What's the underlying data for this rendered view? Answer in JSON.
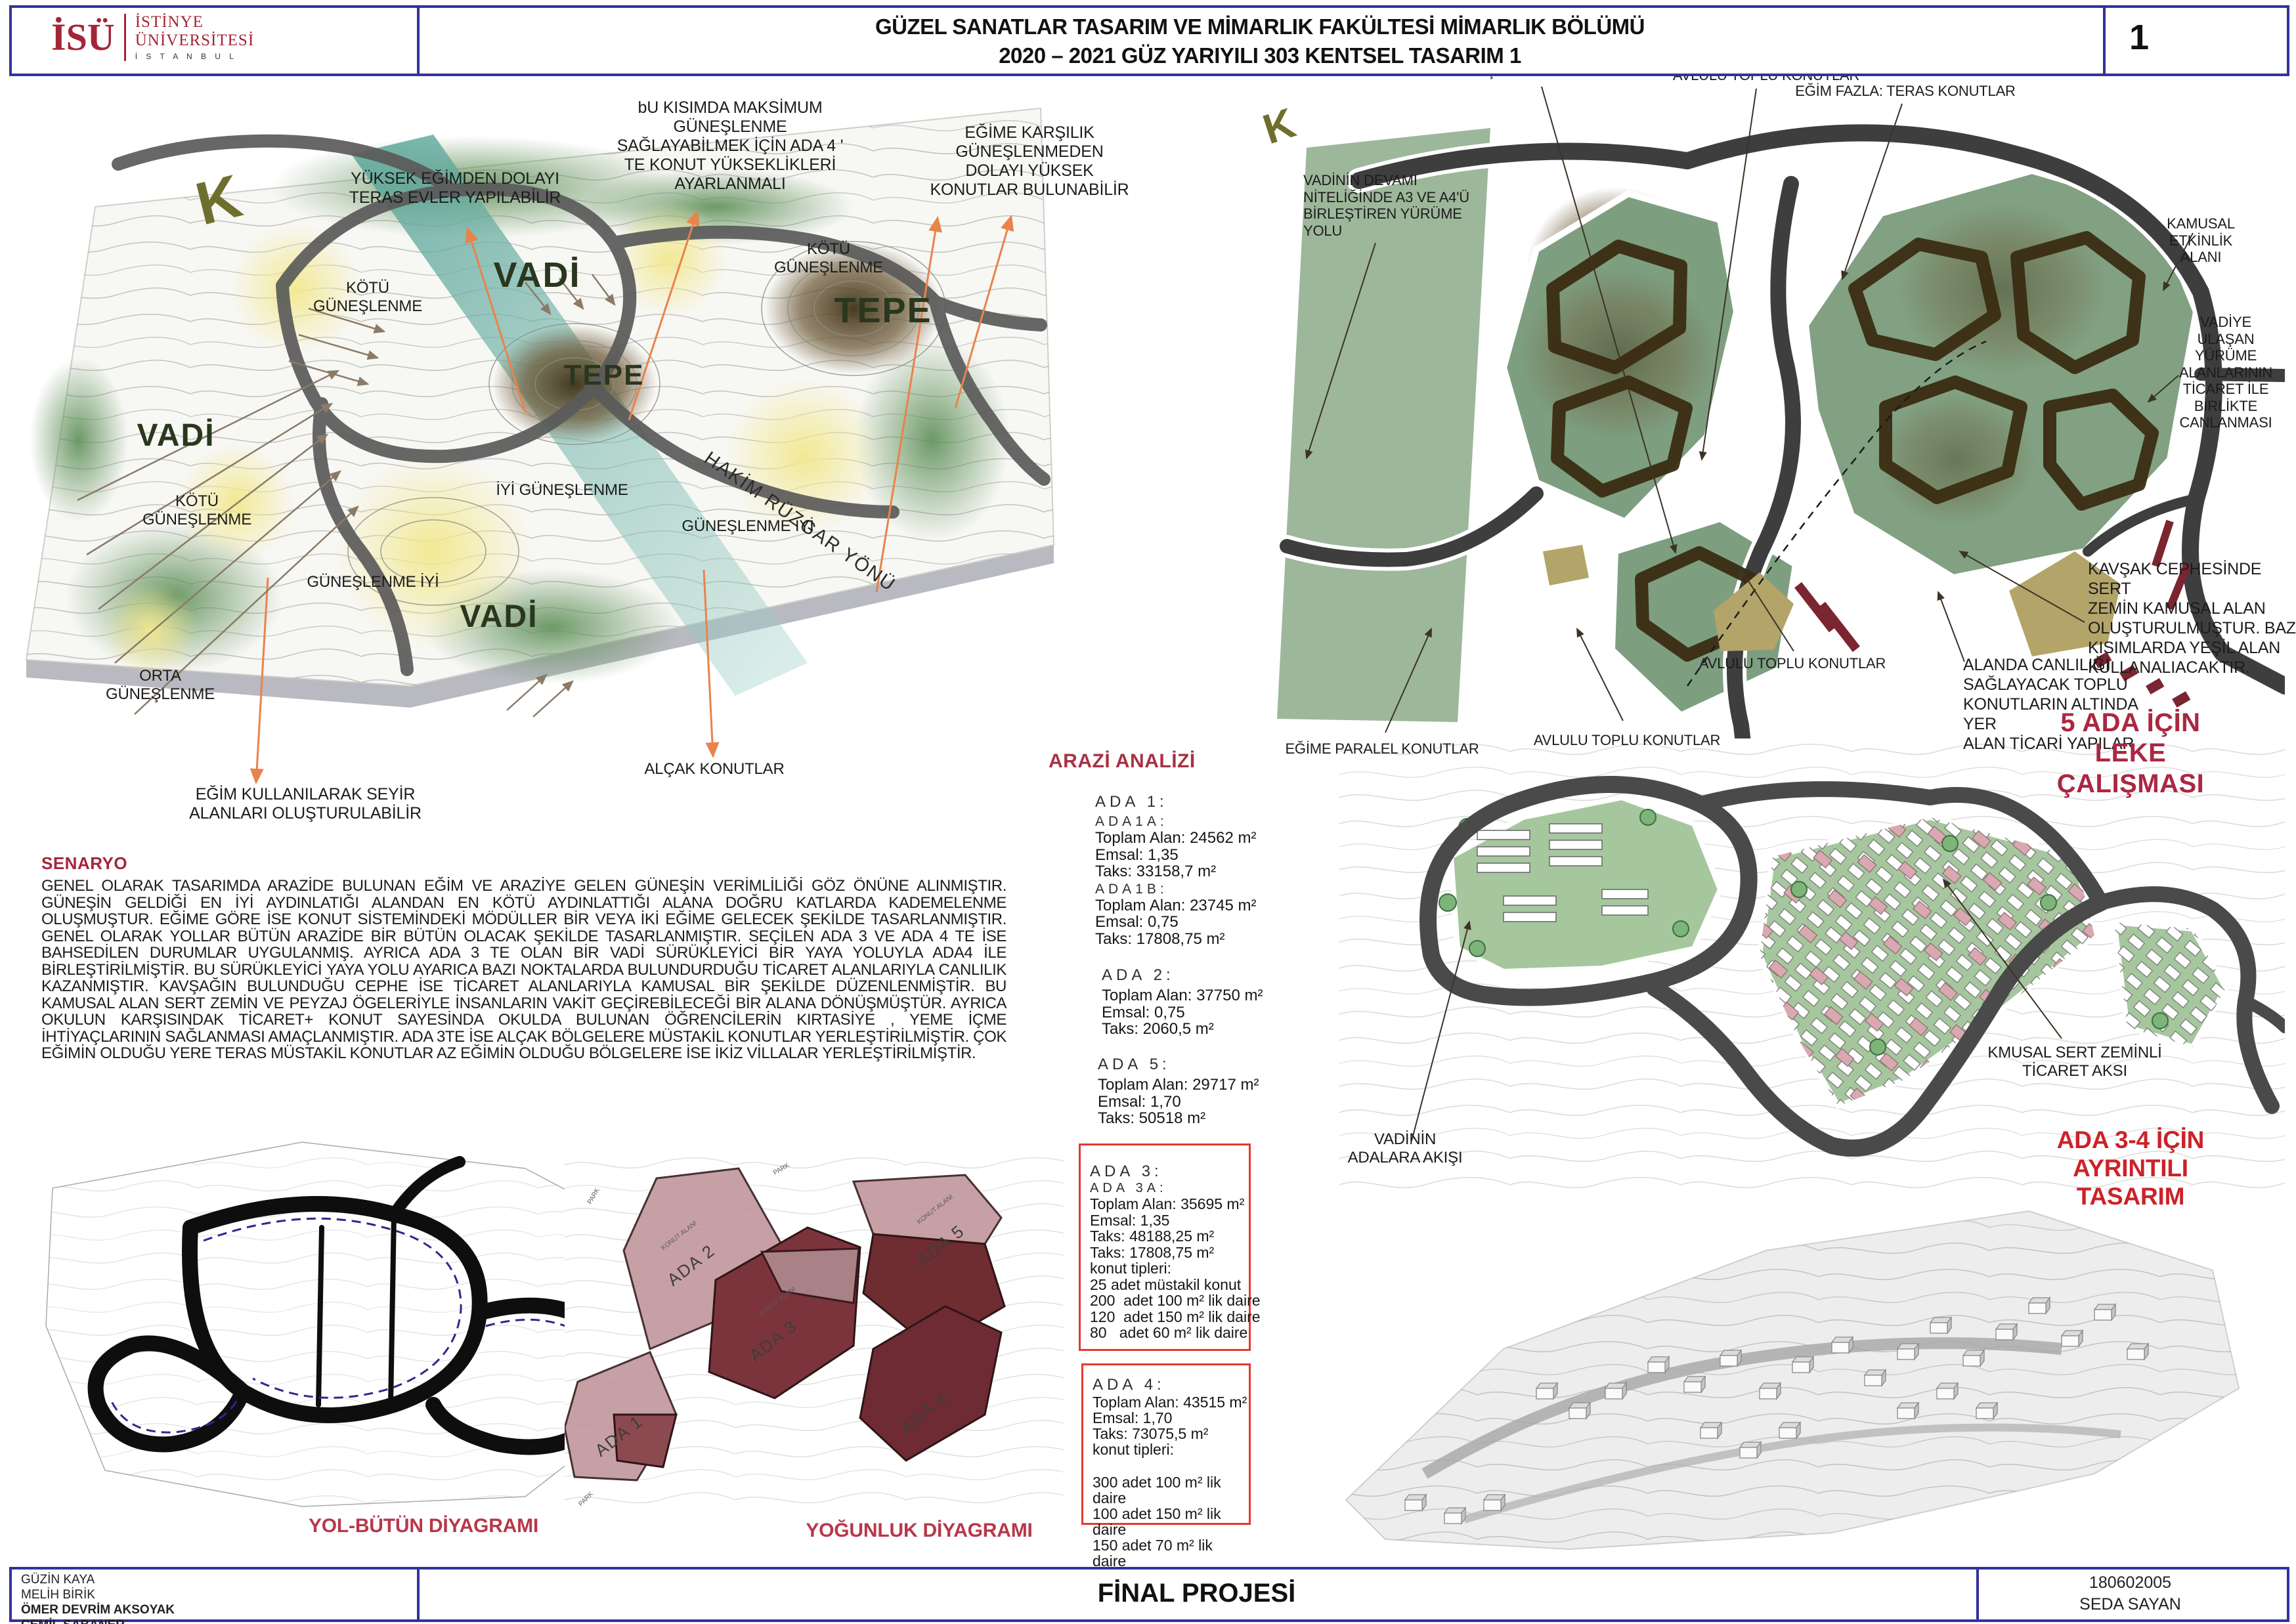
{
  "header": {
    "logo_acronym": "İSÜ",
    "logo_line1": "İSTİNYE",
    "logo_line2": "ÜNİVERSİTESİ",
    "logo_line3": "İ S T A N B U L",
    "title_line1": "GÜZEL SANATLAR TASARIM VE MİMARLIK FAKÜLTESİ MİMARLIK BÖLÜMÜ",
    "title_line2": "2020 – 2021 GÜZ YARIYILI 303 KENTSEL TASARIM 1",
    "page_number": "1"
  },
  "left_map": {
    "compass": "K",
    "vadi_top": "VADİ",
    "vadi_left": "VADİ",
    "vadi_bottom": "VADİ",
    "tepe_right": "TEPE",
    "tepe_center": "TEPE",
    "kotu_guneslenme_topleft": "KÖTÜ\nGÜNEŞLENME",
    "kotu_guneslenme_topright": "KÖTÜ\nGÜNEŞLENME",
    "kotu_guneslenme_left": "KÖTÜ\nGÜNEŞLENME",
    "iyi_guneslenme": "İYİ GÜNEŞLENME",
    "guneslenme_iyi_mid": "GÜNEŞLENME İYİ",
    "guneslenme_iyi_left": "GÜNEŞLENME İYİ",
    "orta_guneslenme": "ORTA\nGÜNEŞLENME",
    "hakim_ruzgar": "HAKİM RÜZGAR YÖNÜ",
    "ann_teras": "YÜKSEK EĞİMDEN DOLAYI\nTERAS EVLER YAPILABİLİR",
    "ann_maksimum": "bU KISIMDA MAKSİMUM\nGÜNEŞLENME\nSAĞLAYABİLMEK İÇİN ADA 4 '\nTE KONUT YÜKSEKLİKLERİ\nAYARLANMALI",
    "ann_egime_karsilik": "EĞİME KARŞILIK\nGÜNEŞLENMEDEN\nDOLAYI  YÜKSEK\nKONUTLAR BULUNABİLİR",
    "ann_seyir": "EĞİM KULLANILARAK SEYİR\nALANLARI OLUŞTURULABİLİR",
    "ann_alcak": "ALÇAK KONUTLAR"
  },
  "right_map": {
    "compass": "K",
    "ann_okul": "OKUL KARŞISINDAKİ KIRTASİYE ALANI",
    "ann_avlulu_top": "AVLULU TOPLU KONUTLAR",
    "ann_egim_fazla": "EĞİM FAZLA: TERAS KONUTLAR",
    "ann_kamusal": "KAMUSAL ETKİNLİK ALANI",
    "ann_vadinin_devami": "VADİNİN DEVAMI\nNİTELİĞİNDE A3 VE A4'Ü\nBİRLEŞTİREN YÜRÜME YOLU",
    "ann_vadiye": "VADİYE ULAŞAN YÜRÜME\nALANLARININ TİCARET İLE\nBİRLİKTE CANLANMASI",
    "ann_kavsak": "KAVŞAK CEPHESİNDE SERT\nZEMİN KAMUSAL ALAN\nOLUŞTURULMUŞTUR. BAZI\nKISIMLARDA YEŞİL ALAN\nKULLANALIACAKTIR.",
    "ann_alanda": "ALANDA CANLILIĞI\nSAĞLAYACAK TOPLU\nKONUTLARIN ALTINDA YER\nALAN TİCARİ YAPILAR",
    "ann_avlulu_right": "AVLULU TOPLU KONUTLAR",
    "ann_avlulu_bottom": "AVLULU TOPLU KONUTLAR",
    "ann_egime_paralel": "EĞİME PARALEL KONUTLAR",
    "leke_title": "5 ADA İÇİN LEKE ÇALIŞMASI"
  },
  "senaryo": {
    "heading": "SENARYO",
    "body": "GENEL OLARAK TASARIMDA ARAZİDE BULUNAN EĞİM VE ARAZİYE GELEN GÜNEŞİN VERİMLİLİĞİ GÖZ ÖNÜNE ALINMIŞTIR. GÜNEŞİN GELDİĞİ EN İYİ AYDINLATIĞI ALANDAN EN KÖTÜ AYDINLATTIĞI ALANA DOĞRU KATLARDA  KADEMELENME OLUŞMUŞTUR. EĞİME GÖRE İSE KONUT SİSTEMİNDEKİ MÖDÜLLER BİR VEYA İKİ EĞİME GELECEK ŞEKİLDE TASARLANMIŞTIR. GENEL OLARAK YOLLAR BÜTÜN ARAZİDE BİR BÜTÜN OLACAK ŞEKİLDE TASARLANMIŞTIR. SEÇİLEN ADA 3 VE ADA 4 TE İSE BAHSEDİLEN DURUMLAR UYGULANMIŞ. AYRICA ADA 3 TE OLAN BİR VADİ SÜRÜKLEYİCİ BİR YAYA YOLUYLA ADA4 İLE BİRLEŞTİRİLMİŞTİR. BU SÜRÜKLEYİCİ YAYA YOLU AYARICA BAZI NOKTALARDA BULUNDURDUĞU TİCARET ALANLARIYLA CANLILIK KAZANMIŞTIR. KAVŞAĞIN BULUNDUĞU CEPHE İSE TİCARET ALANLARIYLA KAMUSAL BİR ŞEKİLDE DÜZENLENMİŞTİR. BU KAMUSAL ALAN SERT ZEMİN VE PEYZAJ ÖGELERİYLE İNSANLARIN VAKİT GEÇİREBİLECEĞİ BİR ALANA DÖNÜŞMÜŞTÜR. AYRICA OKULUN KARŞISINDAK TİCARET+ KONUT SAYESİNDA OKULDA BULUNAN ÖĞRENCİLERİN KIRTASİYE , YEME İÇME İHTİYAÇLARININ SAĞLANMASI AMAÇLANMIŞTIR. ADA 3TE İSE ALÇAK BÖLGELERE MÜSTAKİL KONUTLAR YERLEŞTİRİLMİŞTİR. ÇOK EĞİMİN OLDUĞU YERE TERAS MÜSTAKİL KONUTLAR AZ EĞİMİN OLDUĞU BÖLGELERE İSE İKİZ VİLLALAR YERLEŞTİRİLMİŞTİR."
  },
  "arazi": {
    "heading": "ARAZİ ANALİZİ",
    "ada1": {
      "title": "ADA 1:",
      "sub_a": "ADA1A:",
      "a_alan": "Toplam Alan: 24562 m²",
      "a_emsal": "Emsal: 1,35",
      "a_taks": "Taks: 33158,7 m²",
      "sub_b": "ADA1B:",
      "b_alan": "Toplam Alan: 23745 m²",
      "b_emsal": "Emsal: 0,75",
      "b_taks": "Taks: 17808,75 m²"
    },
    "ada2": {
      "title": "ADA 2:",
      "alan": "Toplam Alan: 37750 m²",
      "emsal": "Emsal: 0,75",
      "taks": "Taks: 2060,5 m²"
    },
    "ada5": {
      "title": "ADA 5:",
      "alan": "Toplam Alan: 29717 m²",
      "emsal": "Emsal: 1,70",
      "taks": "Taks: 50518 m²"
    },
    "ada3": {
      "title": "ADA 3:",
      "sub": "ADA 3A:",
      "alan": "Toplam Alan: 35695 m²",
      "emsal": "Emsal: 1,35",
      "taks1": "Taks: 48188,25 m²",
      "taks2": "Taks: 17808,75 m²",
      "konut": "konut tipleri:",
      "k1": "25 adet müstakil konut",
      "k2": "200  adet 100 m² lik daire",
      "k3": "120  adet 150 m² lik daire",
      "k4": "80   adet 60 m² lik daire"
    },
    "ada4": {
      "title": "ADA 4:",
      "alan": "Toplam Alan: 43515 m²",
      "emsal": "Emsal: 1,70",
      "taks": "Taks: 73075,5 m²",
      "konut": "konut tipleri:",
      "k1": "300 adet 100 m² lik daire",
      "k2": "100 adet 150 m² lik daire",
      "k3": "150 adet 70 m² lik daire"
    }
  },
  "diagrams": {
    "yol_caption": "YOL-BÜTÜN DİYAGRAMI",
    "yogunluk_caption": "YOĞUNLUK DİYAGRAMI",
    "parcel_ada1": "ADA 1",
    "parcel_ada2": "ADA 2",
    "parcel_ada3": "ADA 3",
    "parcel_ada4": "ADA 4",
    "parcel_ada5": "ADA 5",
    "konut_alani": "KONUT ALANI",
    "park": "PARK"
  },
  "detail_plan": {
    "ann_kmusal": "KMUSAL SERT ZEMİNLİ\nTİCARET AKSI",
    "ann_vadinin_akisi": "VADİNİN\nADALARA AKIŞI",
    "title": "ADA 3-4 İÇİN AYRINTILI TASARIM"
  },
  "footer": {
    "names": [
      "GÜZİN KAYA",
      "MELİH BİRİK",
      "ÖMER DEVRİM AKSOYAK",
      "CEMİL SABANER"
    ],
    "project": "FİNAL PROJESİ",
    "student_no": "180602005",
    "student_name": "SEDA SAYAN"
  },
  "colors": {
    "border_navy": "#32329b",
    "brand_red": "#a32638",
    "caption_red": "#b8374a",
    "bright_red": "#cc2229",
    "olive": "#6f6f2d"
  }
}
